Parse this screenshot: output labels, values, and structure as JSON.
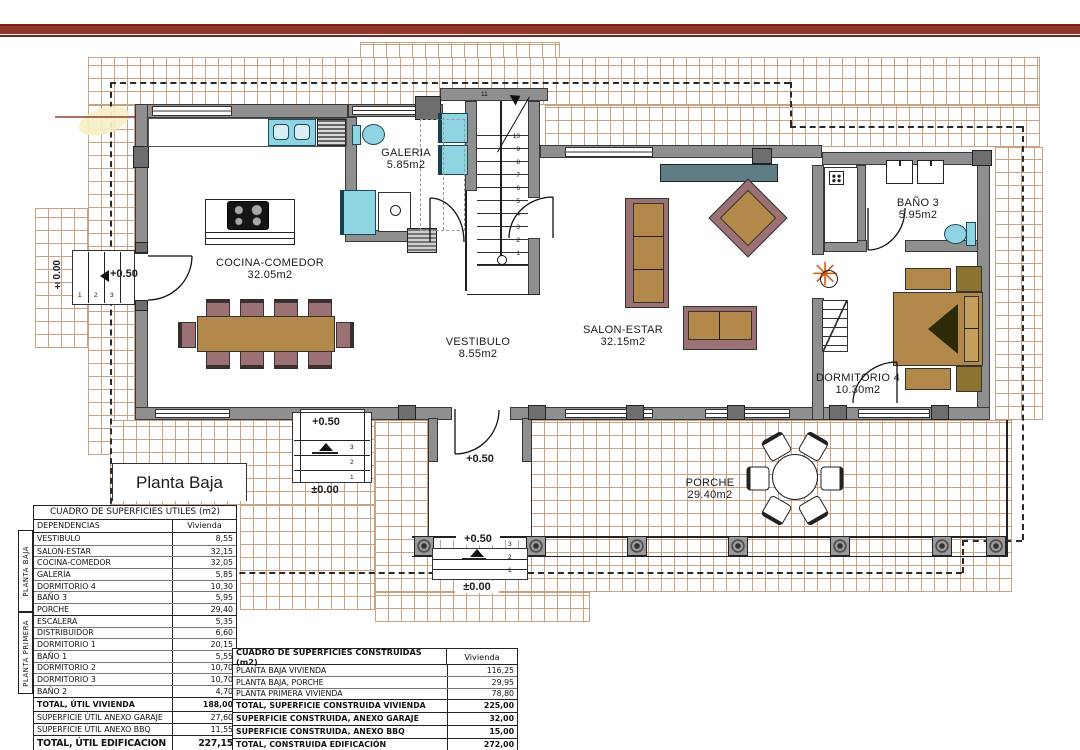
{
  "plan": {
    "floor_label": "Planta Baja",
    "rooms": {
      "galeria": {
        "name": "GALERIA",
        "area": "5.85m2"
      },
      "cocina": {
        "name": "COCINA-COMEDOR",
        "area": "32.05m2"
      },
      "vestibulo": {
        "name": "VESTIBULO",
        "area": "8.55m2"
      },
      "salon": {
        "name": "SALON-ESTAR",
        "area": "32.15m2"
      },
      "bano3": {
        "name": "BAÑO 3",
        "area": "5.95m2"
      },
      "dormitorio4": {
        "name": "DORMITORIO 4",
        "area": "10.30m2"
      },
      "porche": {
        "name": "PORCHE",
        "area": "29.40m2"
      }
    },
    "levels": {
      "plus050": "+0.50",
      "zero": "±0.00"
    },
    "stair_numbers": [
      "1",
      "2",
      "3",
      "4",
      "5",
      "6",
      "7",
      "8",
      "9",
      "10",
      "11"
    ],
    "entry_step_numbers": [
      "1",
      "2",
      "3"
    ],
    "exit_step_numbers": [
      "3",
      "2",
      "1"
    ]
  },
  "tables": {
    "utiles": {
      "title": "CUADRO DE SUPERFICIES UTILES (m2)",
      "col_dependencias": "DEPENDENCIAS",
      "col_vivienda": "Vivienda",
      "groups": [
        {
          "label": "PLANTA BAJA",
          "rows": [
            [
              "VESTIBULO",
              "8,55"
            ],
            [
              "SALON-ESTAR",
              "32,15"
            ],
            [
              "COCINA-COMEDOR",
              "32,05"
            ],
            [
              "GALERÍA",
              "5,85"
            ],
            [
              "DORMITORIO 4",
              "10,30"
            ],
            [
              "BAÑO 3",
              "5,95"
            ],
            [
              "PORCHE",
              "29,40"
            ]
          ]
        },
        {
          "label": "PLANTA PRIMERA",
          "rows": [
            [
              "ESCALERA",
              "5,35"
            ],
            [
              "DISTRIBUIDOR",
              "6,60"
            ],
            [
              "DORMITORIO 1",
              "20,15"
            ],
            [
              "BAÑO 1",
              "5,55"
            ],
            [
              "DORMITORIO 2",
              "10,70"
            ],
            [
              "DORMITORIO 3",
              "10,70"
            ],
            [
              "BAÑO 2",
              "4,70"
            ]
          ]
        }
      ],
      "totals": [
        {
          "label": "TOTAL, ÚTIL VIVIENDA",
          "value": "188,00",
          "bold": true,
          "large": false
        },
        {
          "label": "SUPERFICIE ÚTIL ANEXO GARAJE",
          "value": "27,60",
          "bold": false,
          "large": false
        },
        {
          "label": "SUPERFICIE ÚTIL ANEXO BBQ",
          "value": "11,55",
          "bold": false,
          "large": false
        },
        {
          "label": "TOTAL, ÚTIL EDIFICACION",
          "value": "227,15",
          "bold": true,
          "large": true
        }
      ]
    },
    "construidas": {
      "title": "CUADRO DE SUPERFICIES CONSTRUIDAS (m2)",
      "col_vivienda": "Vivienda",
      "rows": [
        [
          "PLANTA BAJA VIVIENDA",
          "116,25"
        ],
        [
          "PLANTA BAJA, PORCHE",
          "29,95"
        ],
        [
          "PLANTA PRIMERA VIVIENDA",
          "78,80"
        ]
      ],
      "totals": [
        {
          "label": "TOTAL, SUPERFICIE CONSTRUIDA VIVIENDA",
          "value": "225,00"
        },
        {
          "label": "SUPERFICIE CONSTRUIDA, ANEXO GARAJE",
          "value": "32,00"
        },
        {
          "label": "SUPERFICIE CONSTRUIDA, ANEXO BBQ",
          "value": "15,00"
        },
        {
          "label": "TOTAL, CONSTRUIDA EDIFICACIÓN",
          "value": "272,00"
        }
      ]
    }
  },
  "colors": {
    "accent_red": "#93372b",
    "accent_red_dark": "#7a241c",
    "tile_line": "#c9a183",
    "wall_gray": "#8f8f8f",
    "furniture_brown": "#b2894a",
    "chair_mauve": "#9b7173",
    "fixture_cyan": "#8fd4e2",
    "console_teal": "#5f7d85",
    "plant_orange": "#d4590f"
  }
}
